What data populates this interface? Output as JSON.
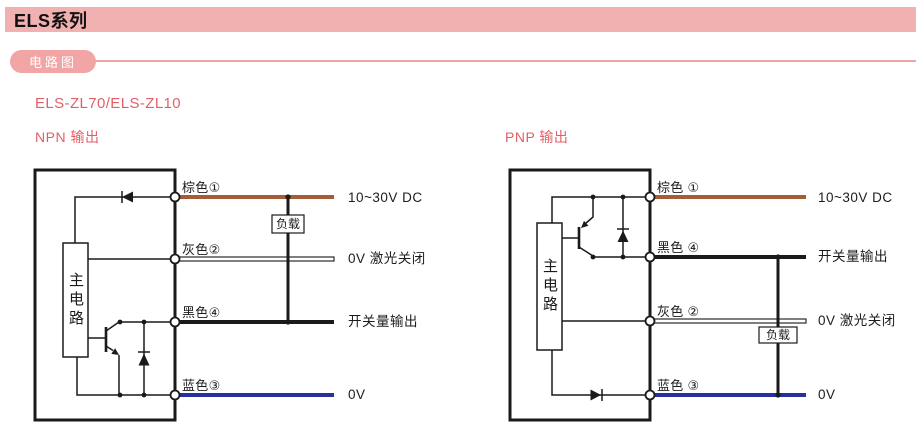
{
  "page_title": "ELS系列",
  "section_badge": "电路图",
  "model_heading": "ELS-ZL70/ELS-ZL10",
  "colors": {
    "header-bg": "#f2b1b1",
    "pill-bg": "#f1a5a5",
    "divider": "#efa3a3",
    "accent": "#e25f66",
    "wire-brown": "#a55c38",
    "wire-blue": "#2a2fa0",
    "wire-black": "#1a1a1a",
    "line": "#1a1a1a"
  },
  "diagrams": [
    {
      "heading": "NPN 输出",
      "main_circuit_label": "主电路",
      "load_label": "负载",
      "terminals": [
        {
          "label": "棕色①",
          "signal": "10~30V DC",
          "wire_color": "brown"
        },
        {
          "label": "灰色②",
          "signal": "0V 激光关闭",
          "wire_color": "gray"
        },
        {
          "label": "黑色④",
          "signal": "开关量输出",
          "wire_color": "black"
        },
        {
          "label": "蓝色③",
          "signal": "0V",
          "wire_color": "blue"
        }
      ]
    },
    {
      "heading": "PNP 输出",
      "main_circuit_label": "主电路",
      "load_label": "负载",
      "terminals": [
        {
          "label": "棕色 ①",
          "signal": "10~30V DC",
          "wire_color": "brown"
        },
        {
          "label": "黑色 ④",
          "signal": "开关量输出",
          "wire_color": "black"
        },
        {
          "label": "灰色 ②",
          "signal": "0V 激光关闭",
          "wire_color": "gray"
        },
        {
          "label": "蓝色 ③",
          "signal": "0V",
          "wire_color": "blue"
        }
      ]
    }
  ]
}
